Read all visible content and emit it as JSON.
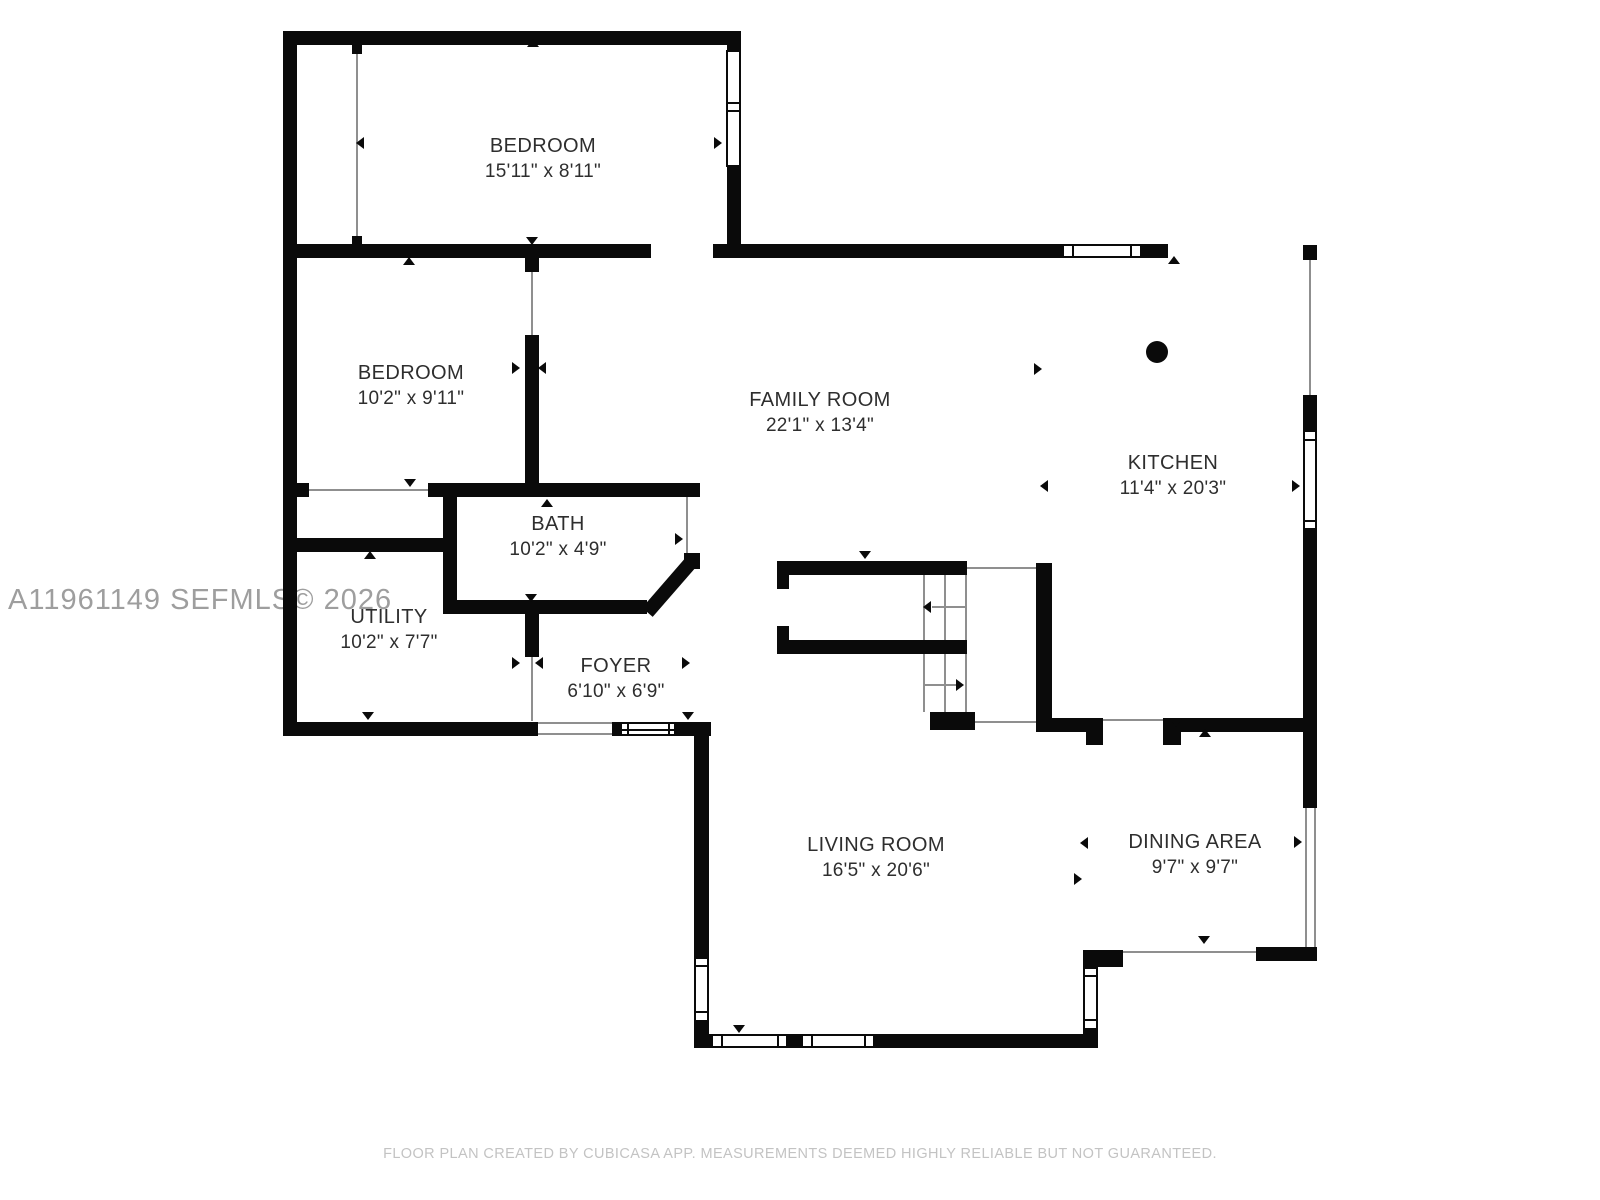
{
  "page": {
    "background": "#ffffff",
    "wall_color": "#0a0a0a",
    "thin_line_color": "#8f8f8f"
  },
  "watermark": {
    "text": "A11961149  SEFMLS© 2026",
    "color": "#9e9e9e"
  },
  "footer": {
    "text": "FLOOR PLAN CREATED BY CUBICASA APP. MEASUREMENTS DEEMED HIGHLY RELIABLE BUT NOT GUARANTEED.",
    "color": "#c3c3c3"
  },
  "rooms": [
    {
      "id": "bedroom-1",
      "name": "BEDROOM",
      "dims": "15'11\" x 8'11\""
    },
    {
      "id": "bedroom-2",
      "name": "BEDROOM",
      "dims": "10'2\" x 9'11\""
    },
    {
      "id": "family-room",
      "name": "FAMILY ROOM",
      "dims": "22'1\" x 13'4\""
    },
    {
      "id": "kitchen",
      "name": "KITCHEN",
      "dims": "11'4\" x 20'3\""
    },
    {
      "id": "bath",
      "name": "BATH",
      "dims": "10'2\" x 4'9\""
    },
    {
      "id": "utility",
      "name": "UTILITY",
      "dims": "10'2\" x 7'7\""
    },
    {
      "id": "foyer",
      "name": "FOYER",
      "dims": "6'10\" x 6'9\""
    },
    {
      "id": "living-room",
      "name": "LIVING ROOM",
      "dims": "16'5\" x 20'6\""
    },
    {
      "id": "dining-area",
      "name": "DINING AREA",
      "dims": "9'7\" x 9'7\""
    }
  ],
  "icons": {
    "direction-arrow": "small black triangle",
    "stair-arrow": "thin line with triangle head",
    "column-marker": "filled black circle",
    "window": "white rectangle with black frame",
    "opening-line": "thin gray line across wall gap"
  }
}
